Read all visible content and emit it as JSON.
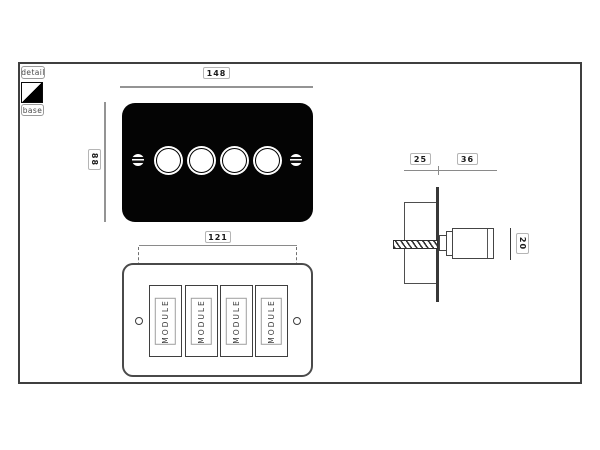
{
  "legend": {
    "detail_label": "detail",
    "base_label": "base"
  },
  "front_view": {
    "width_mm": "148",
    "height_mm": "88"
  },
  "base_view": {
    "screw_spacing_mm": "121",
    "modules": [
      {
        "label": "MODULE"
      },
      {
        "label": "MODULE"
      },
      {
        "label": "MODULE"
      },
      {
        "label": "MODULE"
      }
    ]
  },
  "side_view": {
    "box_depth_mm": "25",
    "knob_projection_mm": "36",
    "knob_diameter_mm": "20"
  },
  "colors": {
    "plate_black": "#040404",
    "frame_line": "#3f3f3f",
    "dimension_line": "#949494",
    "label_border": "#b5b5b5",
    "label_text": "#1a1a1a",
    "module_text": "#3c3c3c"
  }
}
